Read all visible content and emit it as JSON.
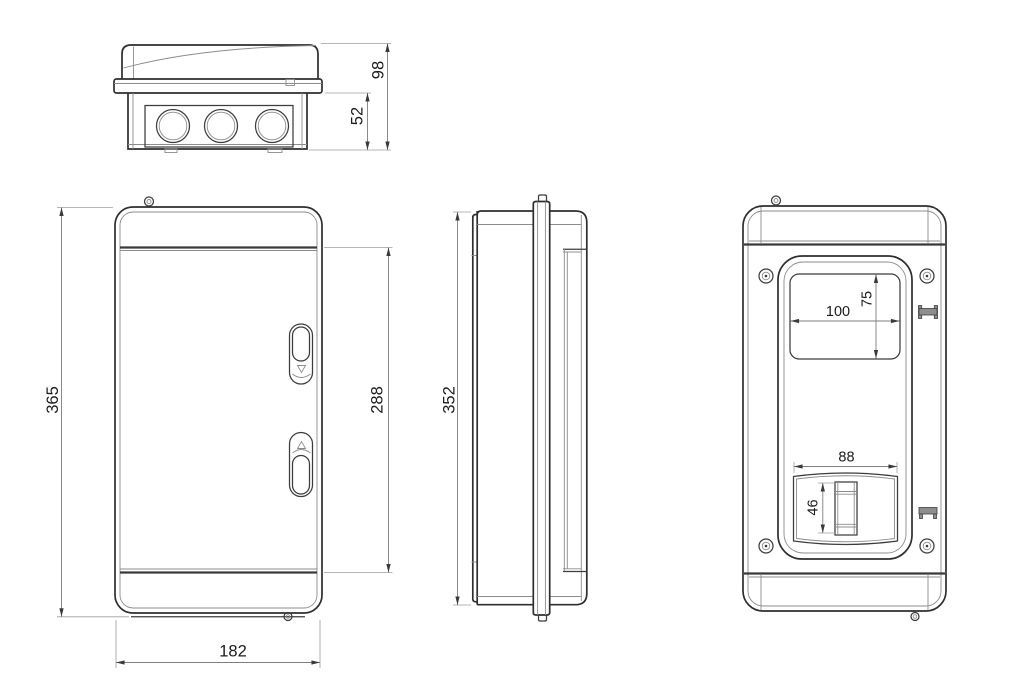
{
  "drawing_type": "enclosure-dimension-drawing",
  "colors": {
    "background": "#ffffff",
    "main_line": "#2e2e2e",
    "thin_line": "#8c8c8c",
    "dimension_line": "#7e7e7e",
    "dimension_text": "#1b1b1b",
    "clip_fill": "#8e8e8e"
  },
  "icons": {
    "screw": "double-circle-with-dot",
    "din_clip": "i-beam-glyph",
    "seal_eyelet": "small-double-circle"
  },
  "views": {
    "top": {
      "dims": {
        "depth_total": "98",
        "depth_base": "52"
      }
    },
    "front": {
      "dims": {
        "height_total": "365",
        "height_door": "288",
        "width_total": "182"
      }
    },
    "side": {
      "dims": {
        "height_total": "352"
      }
    },
    "rear": {
      "dims": {
        "window_width": "100",
        "window_height": "75",
        "cutout_width": "88",
        "cutout_height": "46"
      }
    }
  }
}
